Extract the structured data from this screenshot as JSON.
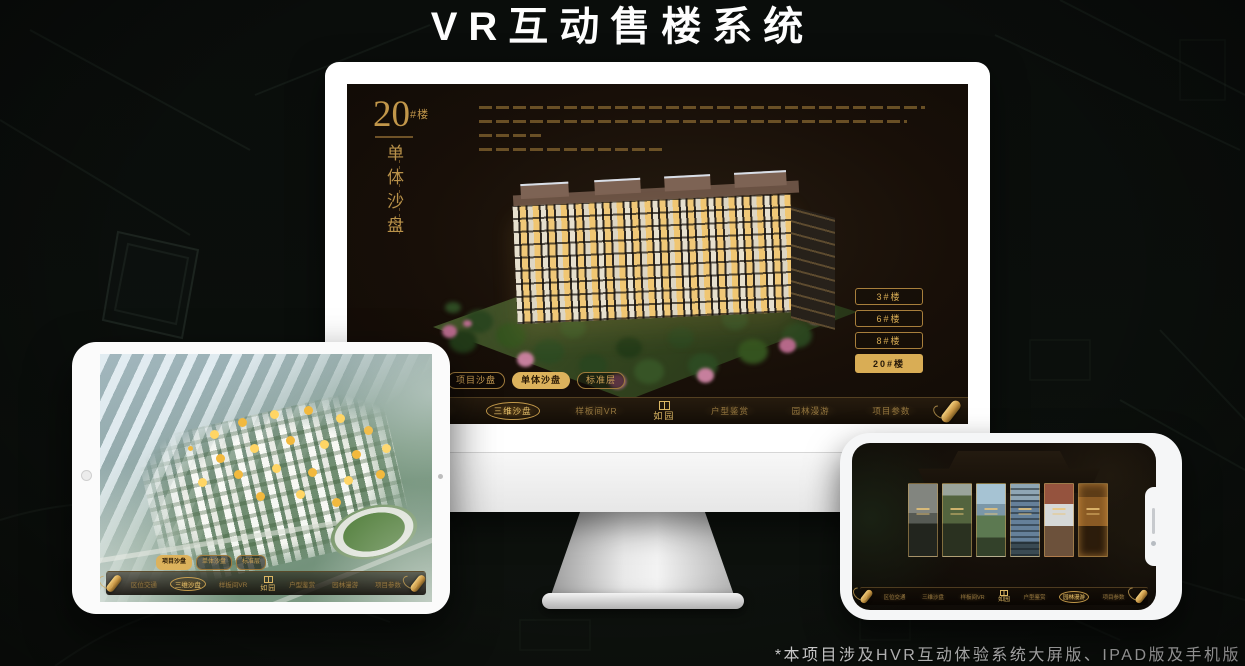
{
  "page": {
    "title": "VR互动售楼系统",
    "footnote": "*本项目涉及HVR互动体验系统大屏版、IPAD版及手机版"
  },
  "colors": {
    "gold": "#c79b4e",
    "gold_bright": "#e9bf6a",
    "selected_fill": "#dcb25c",
    "screen_bg": "#16100a",
    "page_bg": "#0b0e0c"
  },
  "monitor": {
    "headline": {
      "number": "20",
      "suffix": "#楼",
      "vertical": "单体沙盘"
    },
    "building_buttons": [
      {
        "label": "3#楼",
        "selected": false
      },
      {
        "label": "6#楼",
        "selected": false
      },
      {
        "label": "8#楼",
        "selected": false
      },
      {
        "label": "20#楼",
        "selected": true
      }
    ],
    "subtabs": [
      {
        "label": "项目沙盘",
        "selected": false
      },
      {
        "label": "单体沙盘",
        "selected": true
      },
      {
        "label": "标准层",
        "selected": false
      }
    ],
    "nav": {
      "logo": "如园",
      "items": [
        "区位交通",
        "三维沙盘",
        "样板间VR",
        "户型鉴赏",
        "园林漫游",
        "项目参数"
      ],
      "active": "三维沙盘"
    }
  },
  "tablet": {
    "subtabs": [
      {
        "label": "项目沙盘",
        "selected": true
      },
      {
        "label": "单体沙盘",
        "selected": false
      },
      {
        "label": "标准层",
        "selected": false
      }
    ],
    "nav": {
      "logo": "如园",
      "items": [
        "区位交通",
        "三维沙盘",
        "样板间VR",
        "户型鉴赏",
        "园林漫游",
        "项目参数"
      ],
      "active": "三维沙盘"
    }
  },
  "phone": {
    "nav": {
      "logo": "如园",
      "items": [
        "区位交通",
        "三维沙盘",
        "样板间VR",
        "户型鉴赏",
        "园林漫游",
        "项目参数"
      ],
      "active": "园林漫游"
    }
  }
}
